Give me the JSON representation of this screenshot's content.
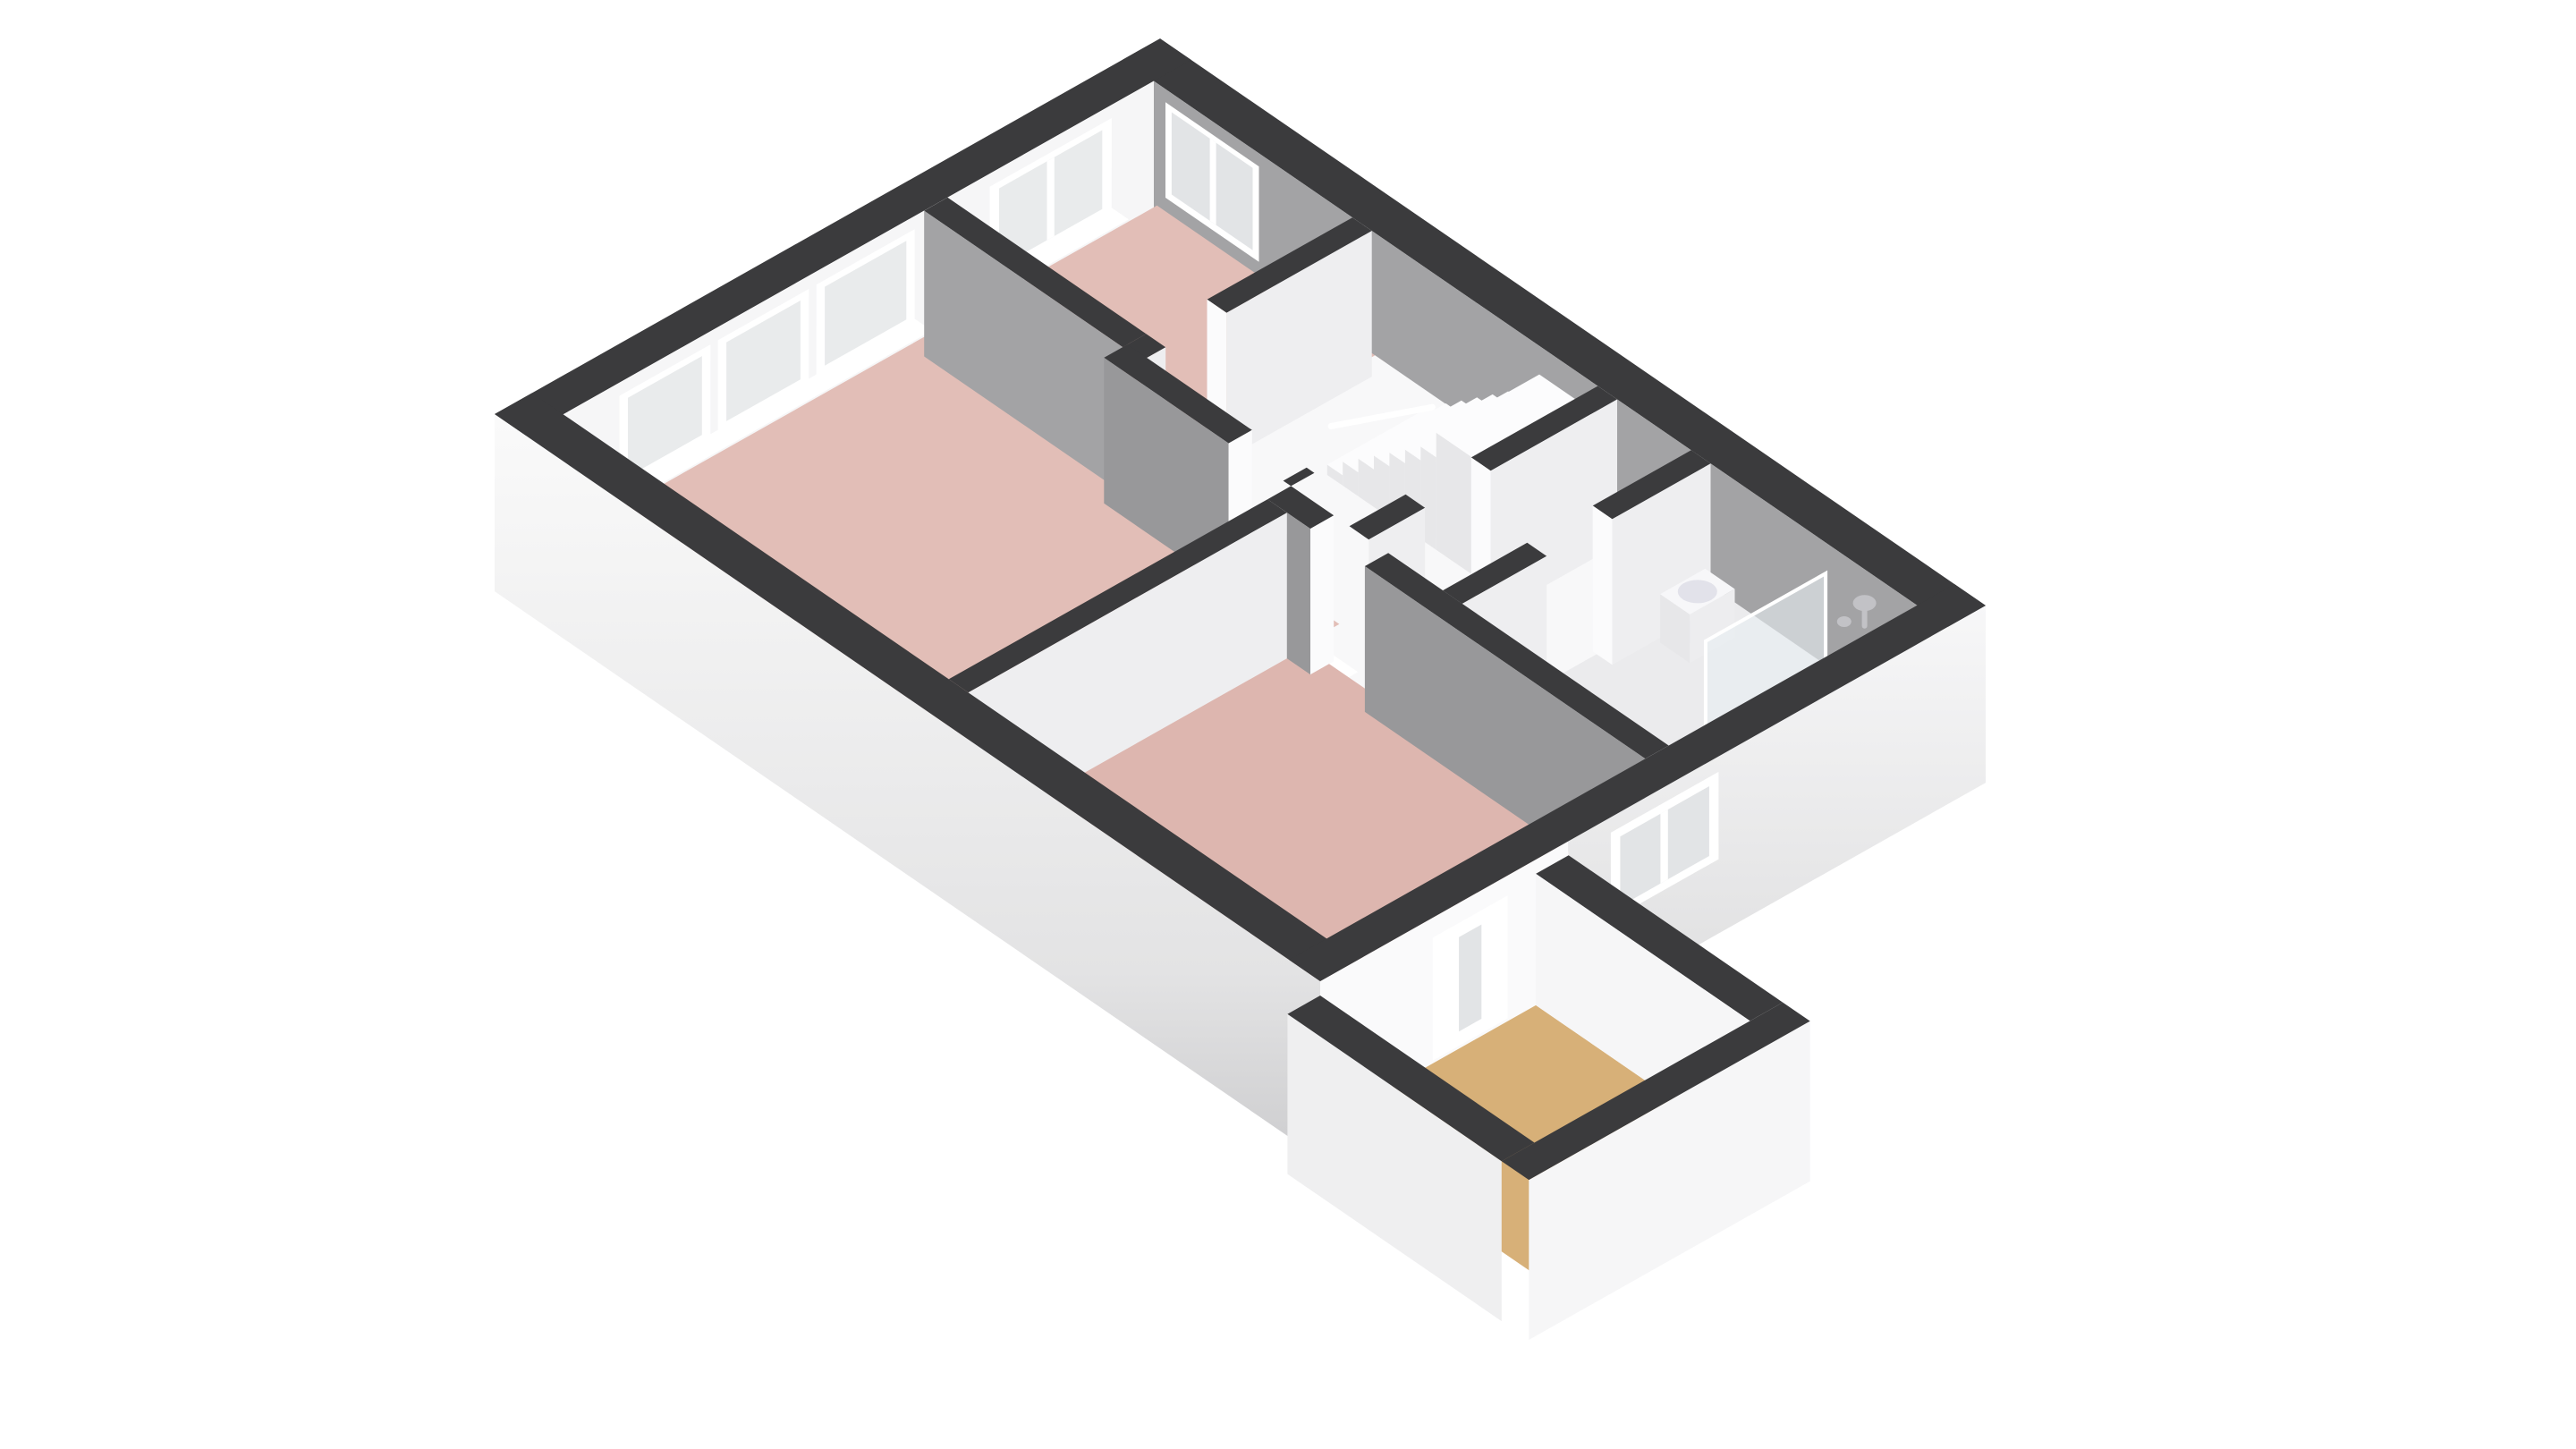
{
  "scene": {
    "kind": "isometric-3d-floorplan",
    "rooms": [
      {
        "name": "living-room",
        "floor": "pink"
      },
      {
        "name": "bedroom-front",
        "floor": "pink"
      },
      {
        "name": "bedroom-back",
        "floor": "pink"
      },
      {
        "name": "hall",
        "floor": "white"
      },
      {
        "name": "landing",
        "floor": "white"
      },
      {
        "name": "bathroom",
        "floor": "gray"
      },
      {
        "name": "balcony",
        "floor": "tan"
      }
    ],
    "fixtures": [
      "staircase",
      "toilet",
      "shower",
      "washbasin",
      "balcony-door"
    ],
    "window_count": 7
  },
  "colors": {
    "background": "#ffffff",
    "wallTop": "#3b3b3d",
    "grayFace": "#a3a3a5",
    "grayFaceDark": "#98989a",
    "lightFace": "#eeeef0",
    "whiteFace": "#f6f6f7",
    "floorPink": "#e2beb7",
    "floorPink2": "#ddb6af",
    "floorTan": "#d7b078",
    "floorHall": "#f8f8f9",
    "floorBath": "#ebebed",
    "outerLight": "#f5f5f6",
    "outerBalcony": "#fafafb",
    "outerParapet": "#efeff0",
    "outerBottom": "#cdcdcf",
    "frameWhite": "#ffffff",
    "glaze": "#e9ebec",
    "glazeDark": "#e2e4e6",
    "stepTop": "#fcfcfd",
    "stepSide": "#e7e7e9",
    "blockFace": "#ededef",
    "fixtureWhite": "#f7f7f9",
    "fixtureShade": "#c9c9d1",
    "fixtureInner": "#e2e2ea",
    "glass": "#e8eef1",
    "metal": "#c2c2c6",
    "jamb": "#fbfbfc"
  }
}
